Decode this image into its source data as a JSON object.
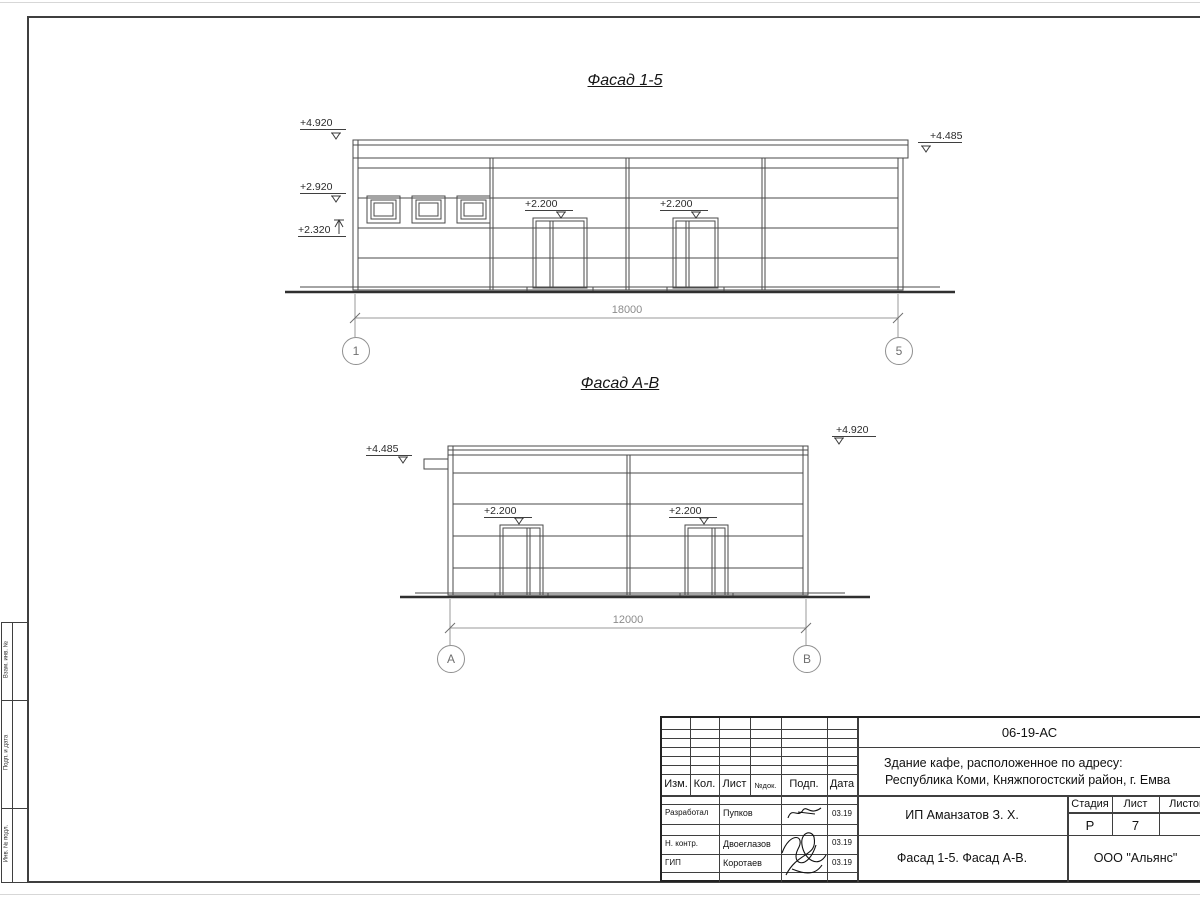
{
  "sheet": {
    "facade1": {
      "title": "Фасад 1-5",
      "dim": "18000",
      "axis_left": "1",
      "axis_right": "5",
      "elev_roof_left": "+4.920",
      "elev_mid_left": "+2.920",
      "elev_low_left": "+2.320",
      "elev_roof_right": "+4.485",
      "elev_door1": "+2.200",
      "elev_door2": "+2.200"
    },
    "facade2": {
      "title": "Фасад А-В",
      "dim": "12000",
      "axis_left": "А",
      "axis_right": "В",
      "elev_roof_left": "+4.485",
      "elev_roof_right": "+4.920",
      "elev_door1": "+2.200",
      "elev_door2": "+2.200"
    },
    "margin_labels": {
      "top": "Взам. инв. №",
      "mid": "Подп. и дата",
      "bottom": "Инв. № подл."
    },
    "title_block": {
      "doc_number": "06-19-АС",
      "project_line1": "Здание кафе, расположенное по адресу:",
      "project_line2": "Республика Коми, Княжпогостский район, г. Емва",
      "col_izm": "Изм.",
      "col_kol": "Кол.",
      "col_list": "Лист",
      "col_ndok": "№док.",
      "col_podp": "Подп.",
      "col_data": "Дата",
      "row1_role": "Разработал",
      "row1_name": "Пупков",
      "row1_date": "03.19",
      "row2_role": "Н. контр.",
      "row2_name": "Двоеглазов",
      "row2_date": "03.19",
      "row3_role": "ГИП",
      "row3_name": "Коротаев",
      "row3_date": "03.19",
      "client": "ИП Аманзатов З. Х.",
      "stage_label": "Стадия",
      "sheet_label": "Лист",
      "sheets_label": "Листов",
      "stage": "Р",
      "sheet_num": "7",
      "sheet_title": "Фасад 1-5. Фасад А-В.",
      "organization": "ООО \"Альянс\""
    }
  },
  "colors": {
    "line": "#4a4a4a",
    "ground": "#2f2f2f",
    "dim": "#9a9a9a",
    "text": "#1c1c1c"
  }
}
